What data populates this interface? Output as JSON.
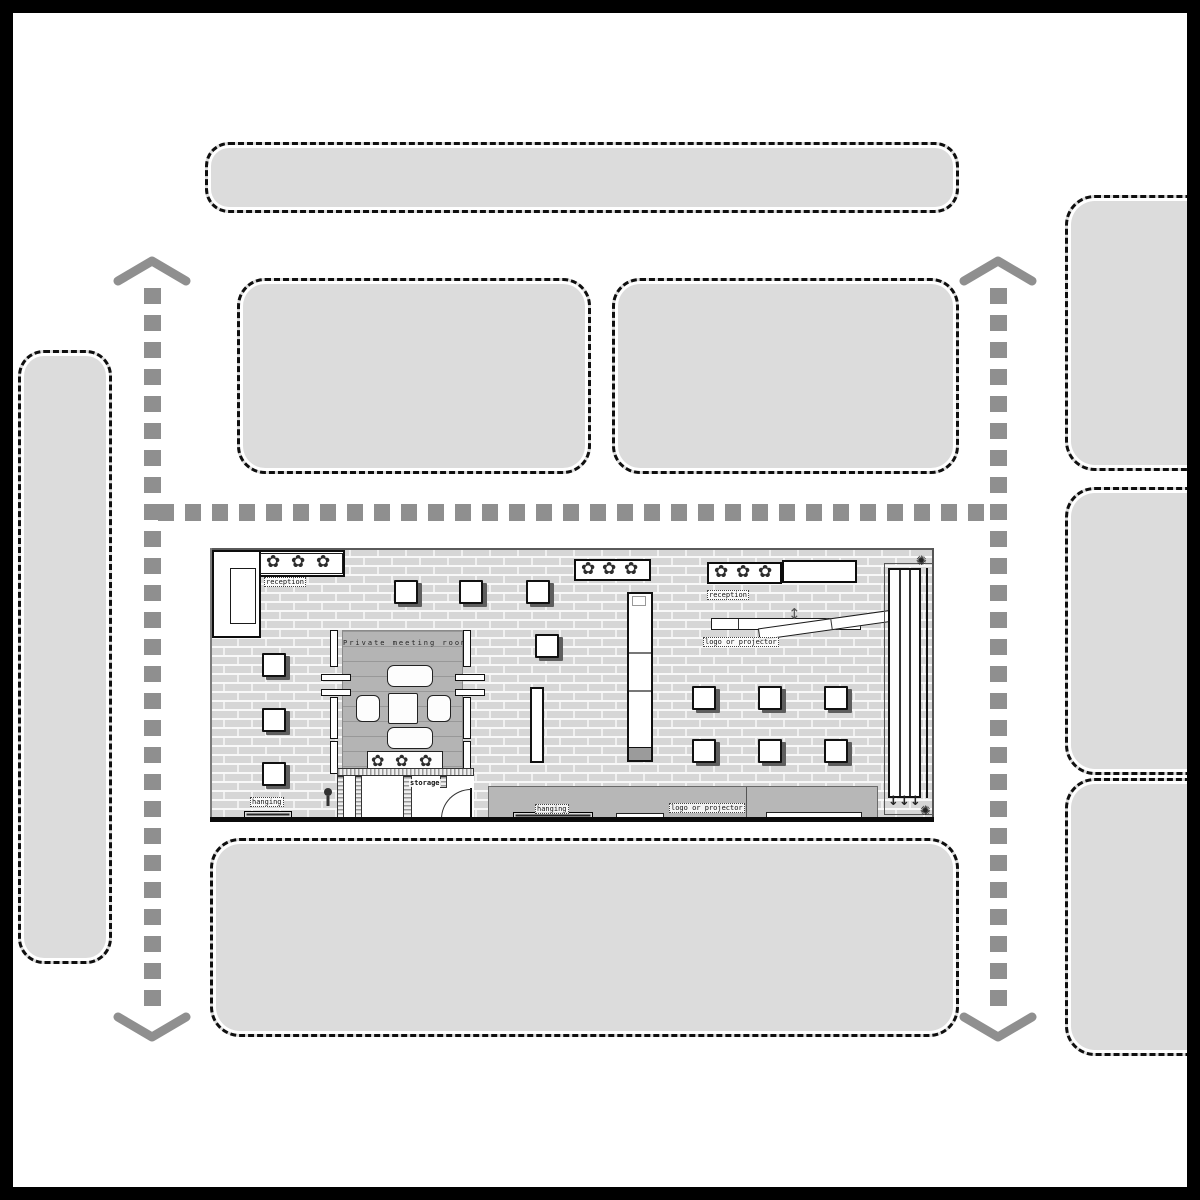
{
  "booth": {
    "labels": {
      "reception_left": "reception",
      "reception_right": "reception",
      "meeting_room": "Private meeting room",
      "storage": "storage",
      "hanging_floor": "hanging",
      "hanging_band": "hanging",
      "logo_projector_swivel": "logo or projector",
      "logo_projector_band": "logo or projector"
    },
    "icons": {
      "stool": "✿",
      "corner_gear": "✺",
      "swivel_arrow": "↕",
      "down_arrow": "↓"
    }
  },
  "colors": {
    "block_fill": "#dcdcdc",
    "block_border": "#0f0f0f",
    "arrow_gray": "#8f8f8f",
    "room_fill": "#b4b4b4",
    "band_fill": "#b7b7b7",
    "frame": "#000000"
  }
}
